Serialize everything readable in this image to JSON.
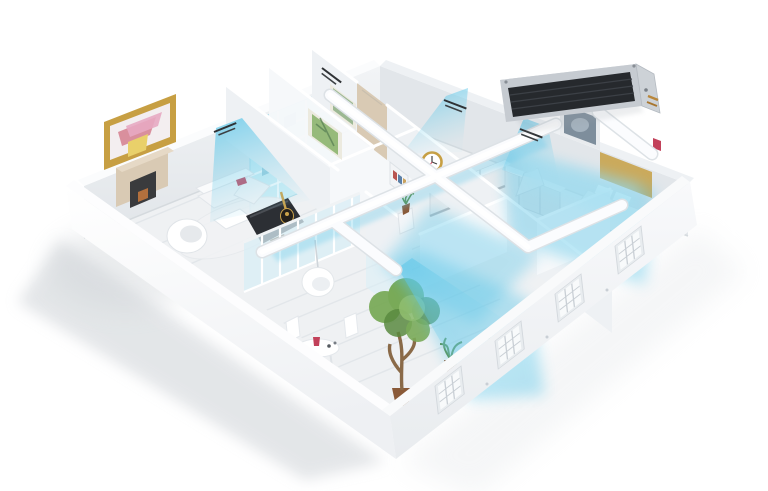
{
  "scene": {
    "subject_label": "3d-apartment-cutaway-floor-plan",
    "ac_unit_label": "ceiling-ducted-air-conditioner-indoor-unit",
    "airflow_label": "cool-air-streams",
    "duct_label": "air-distribution-ducts",
    "vent_label": "ceiling-air-vent",
    "window_label": "multi-pane-window",
    "rooms": [
      {
        "label": "living-room"
      },
      {
        "label": "study-room"
      },
      {
        "label": "hallway"
      },
      {
        "label": "bathroom"
      },
      {
        "label": "kitchen"
      },
      {
        "label": "bedroom"
      },
      {
        "label": "sunroom-dining-area"
      }
    ],
    "objects": [
      {
        "label": "bookshelf"
      },
      {
        "label": "sectional-sofa"
      },
      {
        "label": "grand-piano"
      },
      {
        "label": "acoustic-guitar"
      },
      {
        "label": "egg-chair"
      },
      {
        "label": "fireplace"
      },
      {
        "label": "framed-painting"
      },
      {
        "label": "wall-clock"
      },
      {
        "label": "range-hood"
      },
      {
        "label": "double-bed"
      },
      {
        "label": "hanging-chair"
      },
      {
        "label": "round-table"
      },
      {
        "label": "potted-tree"
      },
      {
        "label": "potted-plants"
      }
    ]
  },
  "colors": {
    "bg": "#ffffff",
    "wallLight": "#fbfcfd",
    "wallMid": "#eef1f4",
    "wallShade": "#e2e6ea",
    "wallFace": "#f6f8fa",
    "floor": "#eff1f3",
    "floorLine": "#dfe3e7",
    "air": "#5cc6e8",
    "airSoft": "#a5e0f2",
    "glass": "#d8eef5",
    "grille": "#26292d",
    "casing": "#c6cbd1",
    "casingDark": "#9aa1a8",
    "gold": "#c79f43",
    "artPink": "#e7a9c2",
    "artYellow": "#e9d06a",
    "artGreen": "#9cb893",
    "wood": "#8a6a48",
    "beige": "#d9cab4",
    "plant": "#79aa58",
    "plantDark": "#59893f",
    "pot": "#8a5a38",
    "dark": "#2c2f34",
    "redAccent": "#c2415a",
    "shadow": "#c9ced3"
  }
}
